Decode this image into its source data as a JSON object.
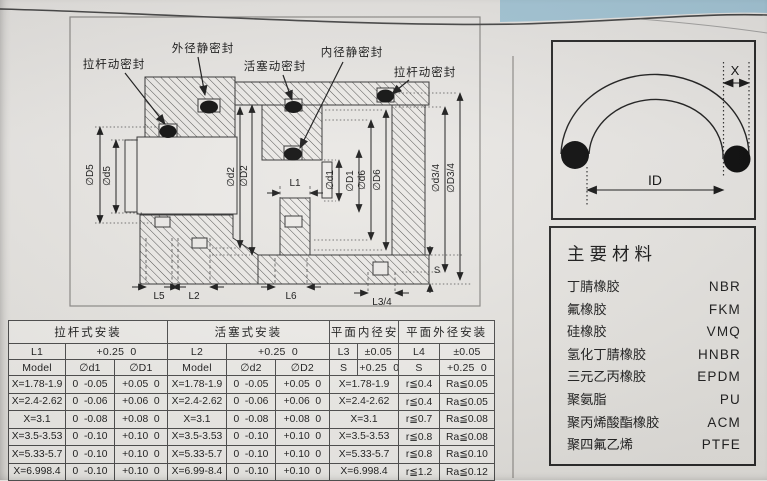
{
  "drawing": {
    "seal_labels": [
      "拉杆动密封",
      "外径静密封",
      "活塞动密封",
      "内径静密封",
      "拉杆动密封"
    ],
    "dims": {
      "D5": "∅D5",
      "d5": "∅d5",
      "d2": "∅d2",
      "D2": "∅D2",
      "d1": "∅d1",
      "D1": "∅D1",
      "d6": "∅d6",
      "D6": "∅D6",
      "d34": "∅d3/4",
      "D34": "∅D3/4",
      "L1": "L1",
      "L5": "L5",
      "L2": "L2",
      "L6": "L6",
      "L34": "L3/4",
      "S": "S"
    }
  },
  "oring": {
    "x_label": "X",
    "id_label": "ID"
  },
  "materials": {
    "title": "主要材料",
    "items": [
      {
        "name": "丁腈橡胶",
        "code": "NBR"
      },
      {
        "name": "氟橡胶",
        "code": "FKM"
      },
      {
        "name": "硅橡胶",
        "code": "VMQ"
      },
      {
        "name": "氢化丁腈橡胶",
        "code": "HNBR"
      },
      {
        "name": "三元乙丙橡胶",
        "code": "EPDM"
      },
      {
        "name": "聚氨脂",
        "code": "PU"
      },
      {
        "name": "聚丙烯酸酯橡胶",
        "code": "ACM"
      },
      {
        "name": "聚四氟乙烯",
        "code": "PTFE"
      }
    ]
  },
  "table": {
    "section_titles": [
      "拉杆式安装",
      "活塞式安装",
      "平面内径安装",
      "平面外径安装"
    ],
    "row2": [
      "L1",
      "+0.25  0",
      "L2",
      "+0.25  0",
      "L3",
      "±0.05",
      "L4",
      "±0.05"
    ],
    "row3": [
      "Model",
      "∅d1",
      "∅D1",
      "Model",
      "∅d2",
      "∅D2",
      "S",
      "+0.25  0",
      "S",
      "+0.25  0"
    ],
    "rows": [
      [
        "X=1.78-1.9",
        "0  -0.05",
        "+0.05  0",
        "X=1.78-1.9",
        "0  -0.05",
        "+0.05  0",
        "X=1.78-1.9",
        "r≦0.4",
        "Ra≦0.05"
      ],
      [
        "X=2.4-2.62",
        "0  -0.06",
        "+0.06  0",
        "X=2.4-2.62",
        "0  -0.06",
        "+0.06  0",
        "X=2.4-2.62",
        "r≦0.4",
        "Ra≦0.05"
      ],
      [
        "X=3.1",
        "0  -0.08",
        "+0.08  0",
        "X=3.1",
        "0  -0.08",
        "+0.08  0",
        "X=3.1",
        "r≦0.7",
        "Ra≦0.08"
      ],
      [
        "X=3.5-3.53",
        "0  -0.10",
        "+0.10  0",
        "X=3.5-3.53",
        "0  -0.10",
        "+0.10  0",
        "X=3.5-3.53",
        "r≦0.8",
        "Ra≦0.08"
      ],
      [
        "X=5.33-5.7",
        "0  -0.10",
        "+0.10  0",
        "X=5.33-5.7",
        "0  -0.10",
        "+0.10  0",
        "X=5.33-5.7",
        "r≦0.8",
        "Ra≦0.10"
      ],
      [
        "X=6.998.4",
        "0  -0.10",
        "+0.10  0",
        "X=6.99-8.4",
        "0  -0.10",
        "+0.10  0",
        "X=6.998.4",
        "r≦1.2",
        "Ra≦0.12"
      ]
    ]
  }
}
